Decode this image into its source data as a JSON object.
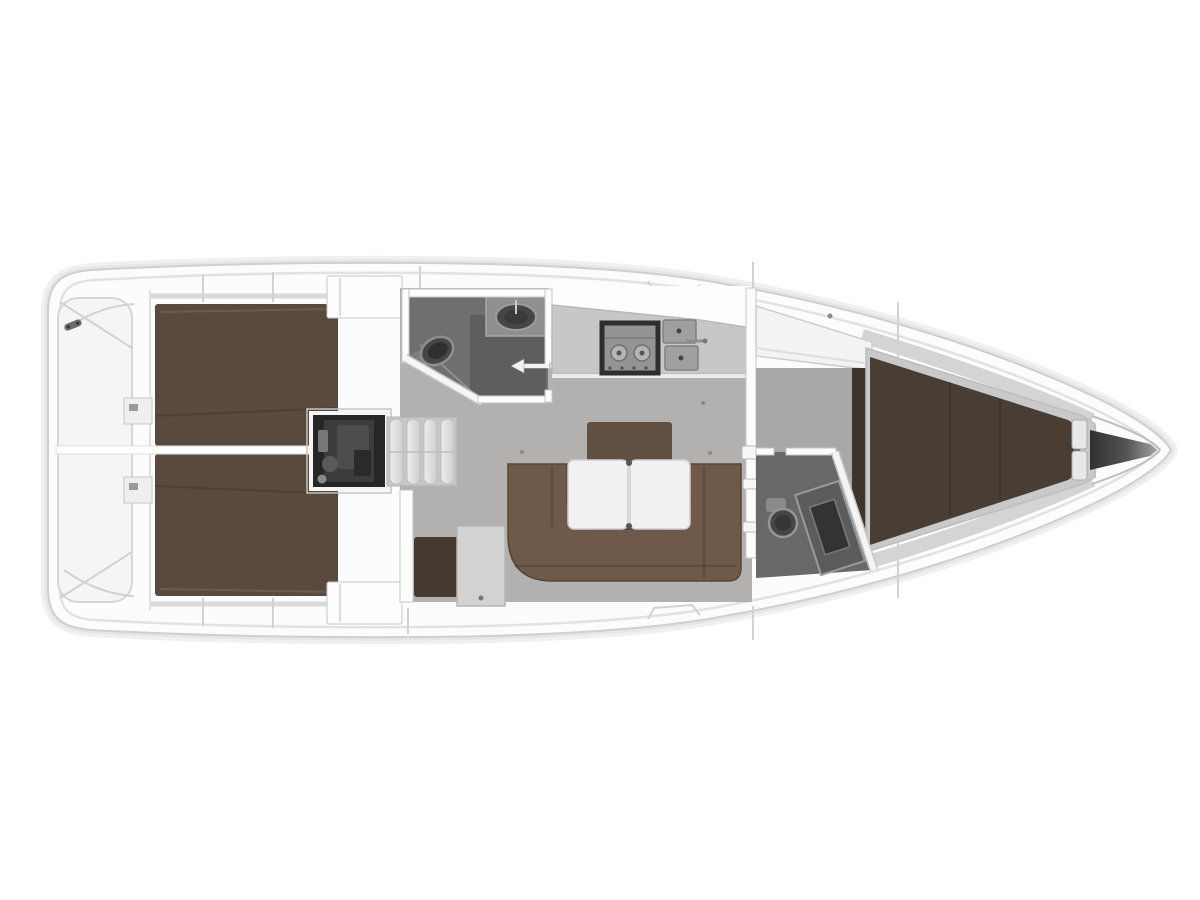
{
  "meta": {
    "description": "Sailing yacht interior layout plan, top view, bow to the right: two aft double cabins, engine compartment with companionway steps, aft head, galley, salon with U-shaped settee and folding table, navigation station, main bulkhead, forward V-berth cabin, forward head and bow anchor locker.",
    "view": "top-down floor plan",
    "orientation": "bow-right"
  },
  "colors": {
    "background": "#ffffff",
    "hull_fill": "#fcfcfc",
    "hull_line": "#cfcfcf",
    "hull_soft1": "#f0f0f0",
    "hull_soft2": "#e6e6e6",
    "deck_line": "#e2e2e2",
    "gunwale": "#dadada",
    "bow_side_band": "#d4d4d4",
    "transom_fill": "#f5f5f5",
    "transom_line": "#d6d6d6",
    "floor_salon": "#b2b1b0",
    "floor_fwd": "#a9a8a7",
    "head_floor_aft": "#6f6f6f",
    "head_floor_fwd": "#686868",
    "shower_dark": "#5e5e5e",
    "counter": "#c7c7c7",
    "counter_sink_top": "#8f8f8f",
    "berth_aft": "#5a4a3e",
    "berth_fwd": "#4a3e34",
    "berth_side": "#3f342c",
    "berth_rim": "#c9c9c9",
    "settee": "#6e594a",
    "settee_back": "#614f41",
    "nav_seat": "#46 3a30",
    "nav_seat_fix": "#463a30",
    "nav_table": "#d2d2d2",
    "table": "#f1f1f1",
    "engine": "#262626",
    "engine_mid": "#3c3c3c",
    "steps_bg": "#c7c7c7",
    "step_tread": "#e6e6e6",
    "fixture_dark": "#464646",
    "fixture_ring": "#949494",
    "stove_frame": "#2e2e2e",
    "stove_top": "#949494",
    "sink_gray": "#a0a0a0",
    "wall_white": "#fcfcfc",
    "wardrobe": "#fdfdfd",
    "anchor_dark": "#303030",
    "anchor_light": "#a3a3a3",
    "cleat": "#6a6a6a",
    "arrow_white": "#f2f2f2"
  },
  "parts": {
    "transom": "stern swim platform",
    "aft_cabin_port": "aft double berth port",
    "aft_cabin_stbd": "aft double berth starboard",
    "engine": "engine compartment",
    "steps": "companionway steps",
    "aft_head": "aft head with toilet and washbasin",
    "galley": "galley with stove and twin sinks",
    "salon": "salon with U-settee and folding table",
    "nav_station": "chart table and navigator seat",
    "bulkhead": "main bulkhead",
    "fwd_cabin": "forward cabin with V-berth",
    "fwd_head": "forward head",
    "anchor_locker": "bow anchor locker"
  }
}
